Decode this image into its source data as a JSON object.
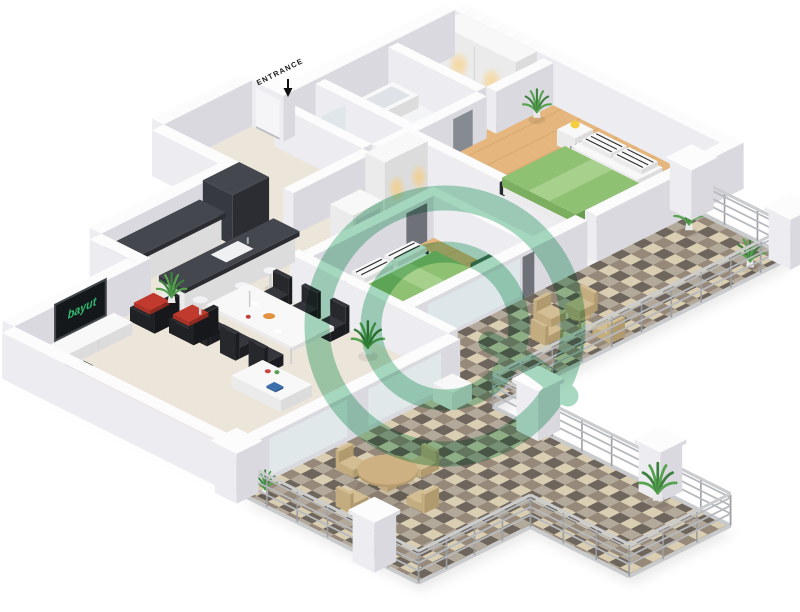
{
  "view": {
    "type": "isometric-3d-floor-plan",
    "bedrooms_depicted": 2,
    "background": "#ffffff"
  },
  "labels": {
    "entrance": "ENTRANCE"
  },
  "tv": {
    "logo_text": "bayut",
    "logo_color": "#2fbf71",
    "screen_color": "#15181b"
  },
  "watermark": {
    "name": "bayut-circular-logo-watermark",
    "color": "#4fb382",
    "opacity": 0.5
  },
  "palette": {
    "wall": "#fcfcfd",
    "wall_shade_left": "#ededf1",
    "wall_shade_right": "#d9d9df",
    "floor_beige": "#ece5d9",
    "floor_wood": "#e5b77f",
    "bath_floor": "#f3f4f6",
    "tile_cream": "#d9cdb2",
    "tile_light_gray": "#b3a99a",
    "tile_dark": "#6e655c",
    "tile_brown": "#97897a",
    "bed_green": "#8fc172",
    "sofa_black": "#26282c",
    "cushion_red": "#b5352c",
    "counter_marble": "#36393f",
    "lamp_yellow": "#f4ce3e",
    "plant_green": "#4f9347",
    "terrace_furniture_tan": "#cdb183",
    "warm_light": "#ffc966"
  },
  "rooms": [
    "entrance-corridor",
    "bathroom",
    "shower-room",
    "walk-in-closet",
    "master-bedroom",
    "second-bedroom",
    "hallway",
    "kitchen",
    "living-dining-room",
    "l-shaped-terrace"
  ],
  "furniture": [
    "wardrobes-with-downlights",
    "master-double-bed-green",
    "second-double-bed-green",
    "nightstands-with-yellow-lamps",
    "green-ottoman-cubes",
    "dark-marble-kitchen-counters",
    "kitchen-sink",
    "bar-stools",
    "dining-table-with-six-black-chairs",
    "black-armchairs-red-cushions",
    "tv-console",
    "wall-tv-with-bayut-logo",
    "black-sofa-red-seat",
    "coffee-table",
    "yellow-table-lamp",
    "bathtub",
    "toilet",
    "round-terrace-table-with-four-chairs",
    "terrace-bistro-set",
    "potted-plants",
    "terrace-railing-with-pillars",
    "checkered-terrace-tiles"
  ]
}
